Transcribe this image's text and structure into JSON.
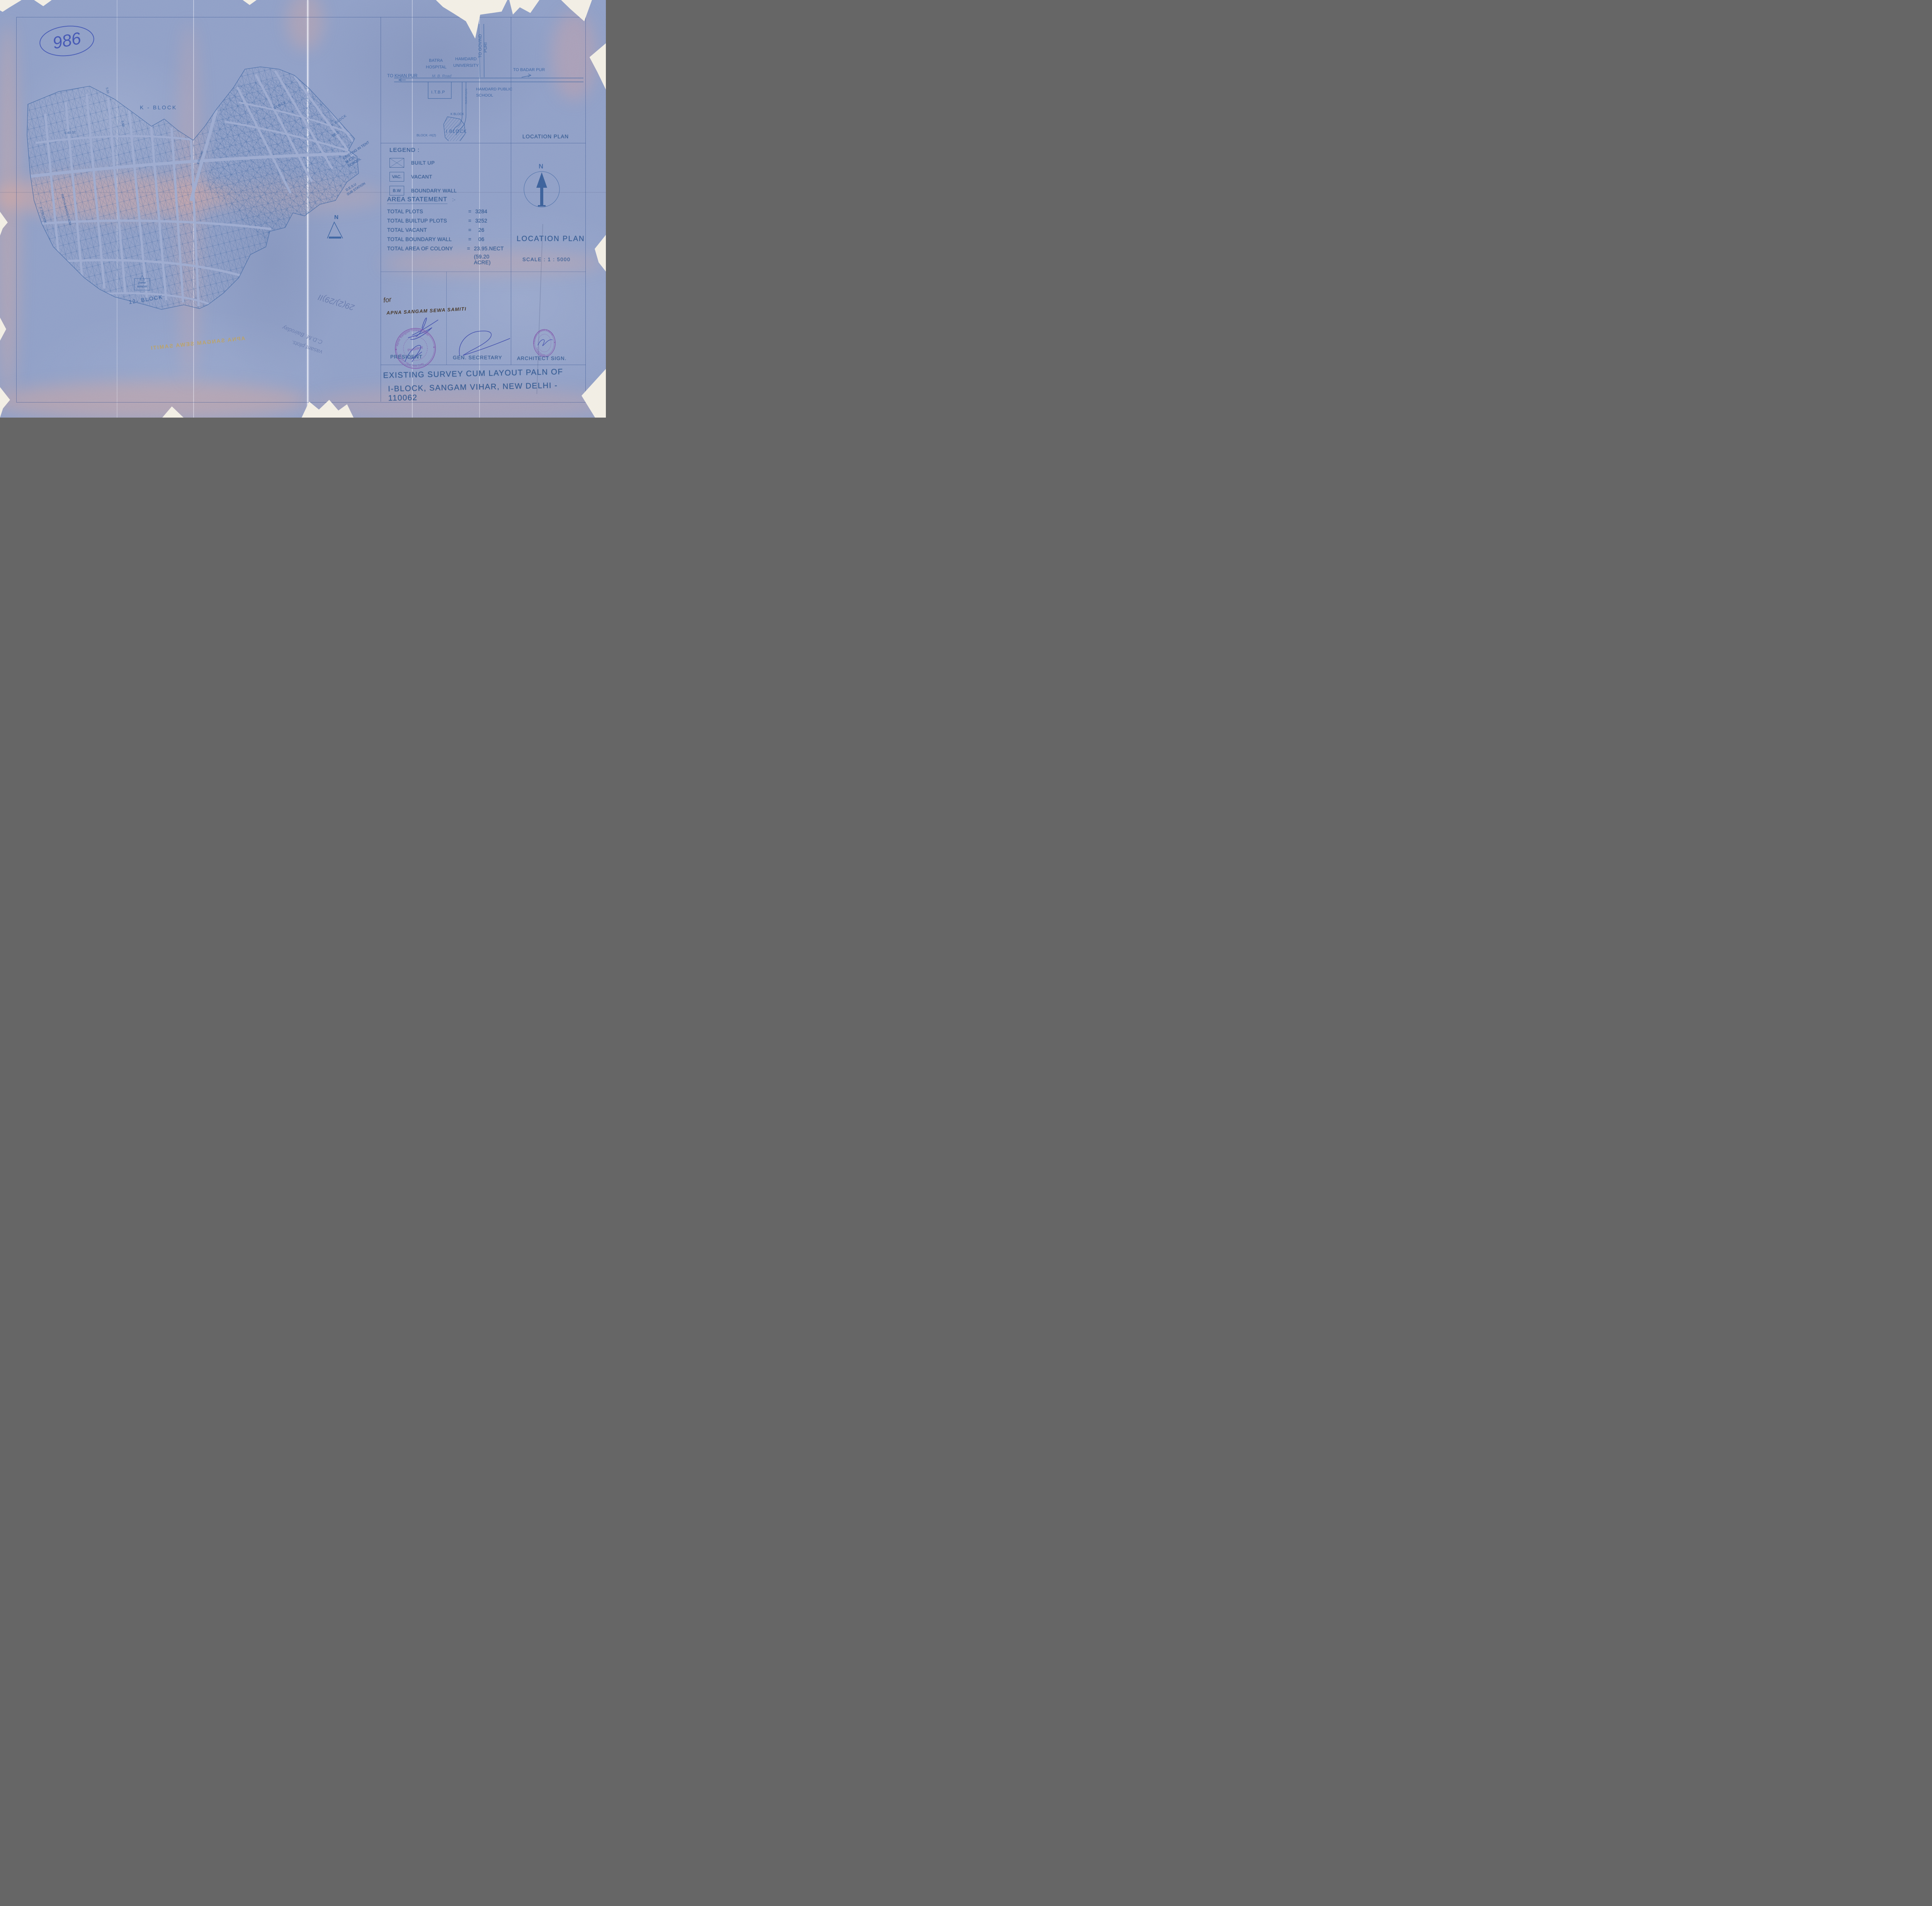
{
  "sheet": {
    "handwritten_number": "986",
    "title_line1": "EXISTING SURVEY CUM LAYOUT PALN OF",
    "title_line2": "I-BLOCK, SANGAM VIHAR, NEW DELHI - 110062"
  },
  "map": {
    "k_block_main": "K - BLOCK",
    "k_block_upper": "BLOCK",
    "k_block_right": "K BLOCK",
    "block_12": "12- BLOCK",
    "street_640": "6.40 ST.",
    "street_550": "5.50",
    "street_950": "9.50 ROAD",
    "ratiya_marg": "RATIYA MARG 7.60M",
    "f2_block": "F 2 BLOCK",
    "school_l1": "EXISTING IN TENT",
    "school_l2": "M.C.D.",
    "school_l3": "SCHOOL",
    "dim_96": "96.0",
    "desu_l1": "D.E.S.U",
    "desu_l2": "SUB STATION",
    "farm": "FARM",
    "mandir": "MANDIR",
    "north": "N",
    "bleed": "APNA SANGAM SEWA SAMITI"
  },
  "location_plan": {
    "corner_label": "LOCATION PLAN",
    "to_govind": "TO GOVIND",
    "puri": "PURI",
    "to_khan_pur": "TO KHAN PUR",
    "to_badar_pur": "TO BADAR PUR",
    "mb_road": "M. B. Road",
    "batra_1": "BATRA",
    "batra_2": "HOSPITAL",
    "hamdard_1": "HAMDARD",
    "hamdard_2": "UNIVERSITY",
    "itbp": "I.T.B.P",
    "ratia_marg": "RATIA MARG",
    "hps_1": "HAMDARD PUBLIC",
    "hps_2": "SCHOOL",
    "k_block": "K BLOCK",
    "i_block": "I BLOCK",
    "block_h2": "BLOCK -H(2)",
    "block_i2": "BLOCK - I (2)",
    "heading": "LOCATION PLAN",
    "scale": "SCALE : 1 : 5000",
    "north": "N"
  },
  "legend": {
    "heading": "LEGEND :",
    "items": [
      {
        "symbol": "crossed-box",
        "label": "BUILT UP"
      },
      {
        "symbol": "VAC.",
        "label": "VACANT"
      },
      {
        "symbol": "B.W",
        "label": "BOUNDARY WALL"
      }
    ]
  },
  "area_statement": {
    "heading": "AREA STATEMENT",
    "heading_suffix": ":-",
    "rows": [
      {
        "label": "TOTAL PLOTS",
        "eq": "=",
        "value": "3284"
      },
      {
        "label": "TOTAL BUILTUP PLOTS",
        "eq": "=",
        "value": "3252"
      },
      {
        "label": "TOTAL VACANT",
        "eq": "=",
        "value": "26"
      },
      {
        "label": "TOTAL BOUNDARY WALL",
        "eq": "=",
        "value": "06"
      },
      {
        "label": "TOTAL AREA OF COLONY",
        "eq": "=",
        "value": "23.95.NECT",
        "value2": "(59.20 ACRE)"
      }
    ]
  },
  "signatures": {
    "for_text": "for",
    "society": "APNA SANGAM SEWA SAMITI",
    "president_label": "PRESIDENT",
    "gen_secretary_label": "GEN. SECRETARY",
    "architect_label": "ARCHITECT SIGN.",
    "president_stamp_top": "Apna Sangam Sewa Samiti",
    "president_stamp_center": "President",
    "president_stamp_bottom": "Sangam Vihar, New Delhi",
    "architect_stamp_top": "SUMER CHAND KHATRI",
    "architect_stamp_bottom": "CA /97/21234",
    "star": "★"
  },
  "annotations": {
    "pencil_note_1": "29(2)/29)II",
    "pencil_note_2": "C.D.M. Bairoday",
    "pencil_note_3": "vasant plots."
  }
}
